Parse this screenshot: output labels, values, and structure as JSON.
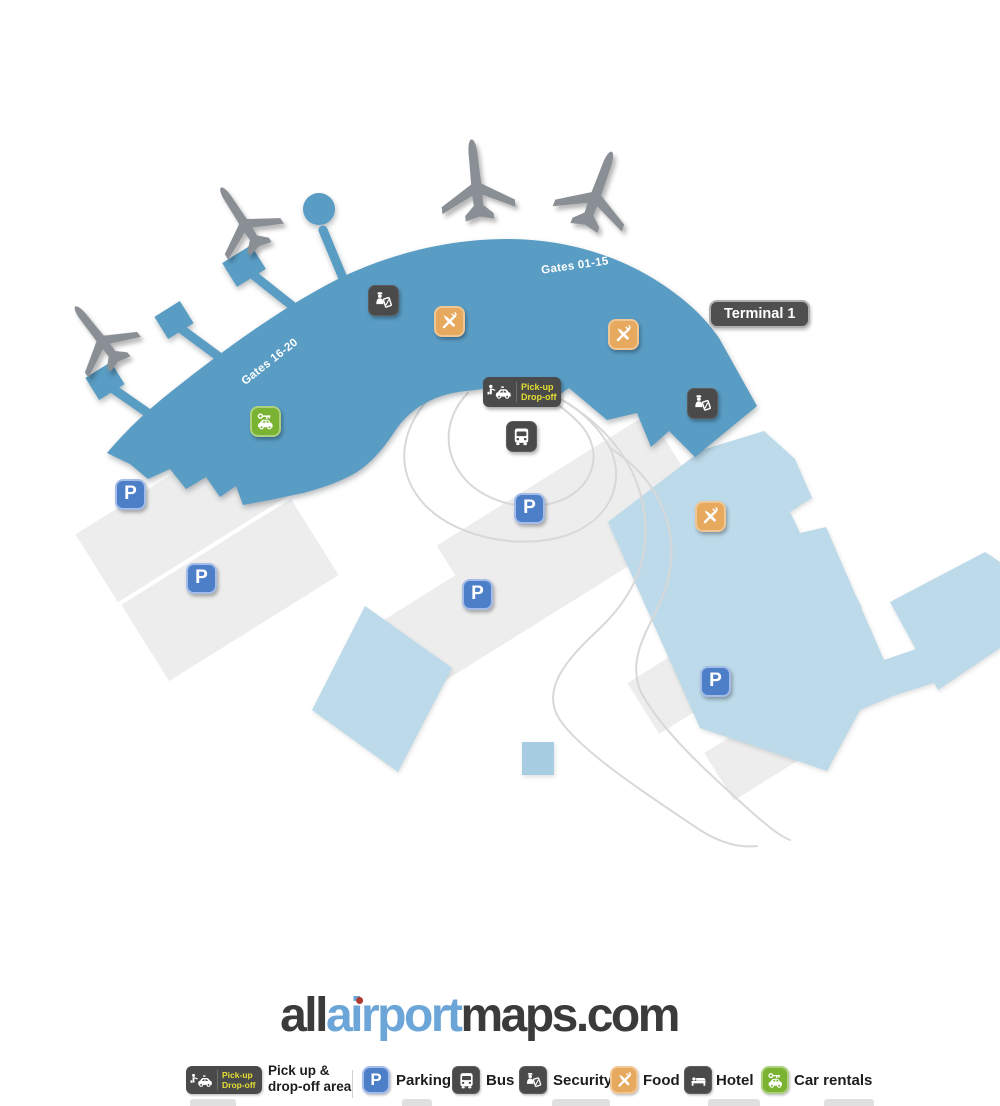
{
  "map": {
    "terminal_label": "Terminal 1",
    "gates_labels": {
      "north": "Gates 01-15",
      "west": "Gates 16-20"
    },
    "parking_symbol": "P",
    "pickup_badge": {
      "line1": "Pick-up",
      "line2": "Drop-off"
    },
    "colors": {
      "terminal_blue": "#599cc4",
      "building_light_blue": "#bcdae9",
      "building_gray": "#ededed",
      "road_gray": "#d8d8d8",
      "plane_gray": "#898f94",
      "badge_dark": "#4a4a4a",
      "parking_blue": "#4d7ec8",
      "food_orange": "#e7a95e",
      "car_rentals_green": "#7ab332",
      "pickup_text_yellow": "#e4de33",
      "logo_blue": "#6ca6d8",
      "logo_dark": "#3b3b3b"
    }
  },
  "footer": {
    "logo": {
      "part1": "all",
      "part2": "airport",
      "part3": "maps.com"
    },
    "legend": {
      "pickup": {
        "badge_line1": "Pick-up",
        "badge_line2": "Drop-off",
        "label_line1": "Pick up &",
        "label_line2": "drop-off area"
      },
      "parking": {
        "symbol": "P",
        "label": "Parking"
      },
      "bus": {
        "label": "Bus"
      },
      "security": {
        "label": "Security"
      },
      "food": {
        "label": "Food"
      },
      "hotel": {
        "label": "Hotel"
      },
      "car_rentals": {
        "label": "Car rentals"
      }
    }
  }
}
